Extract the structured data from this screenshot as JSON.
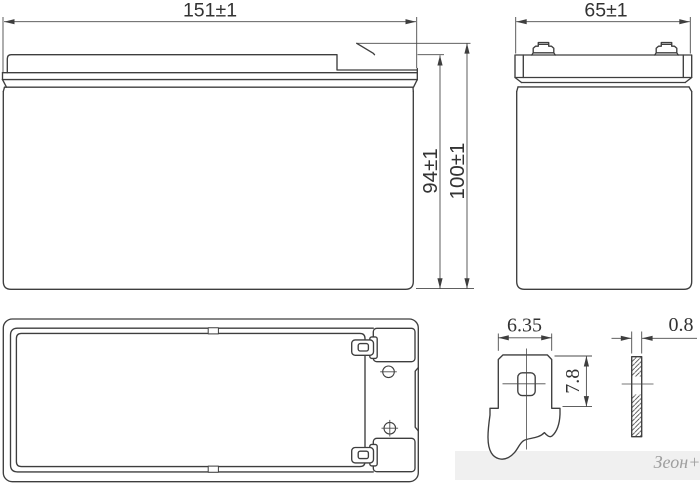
{
  "drawing": {
    "type": "battery-outline-dimensional-drawing",
    "views": {
      "front": {
        "width_dim": "151±1",
        "case_height_dim": "94±1",
        "overall_height_dim": "100±1"
      },
      "side": {
        "depth_dim": "65±1"
      },
      "terminal_detail": {
        "blade_width_dim": "6.35",
        "blade_height_dim": "7.8",
        "blade_thickness_dim": "0.8"
      }
    },
    "symbols": {
      "negative_vent": "minus-circle-icon",
      "positive_vent": "plus-circle-icon"
    },
    "watermark": "Зеон+"
  }
}
